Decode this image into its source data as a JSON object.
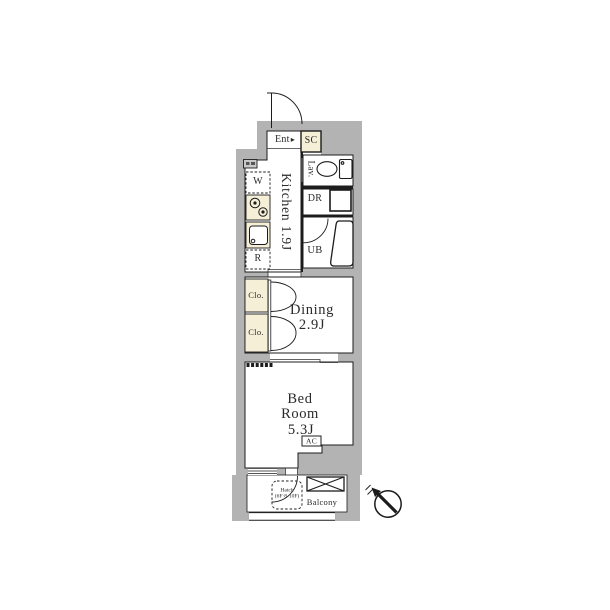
{
  "floorplan": {
    "rooms": {
      "entrance": {
        "label": "Ent"
      },
      "shoe_closet": {
        "label": "SC"
      },
      "lavatory": {
        "label": "Lav."
      },
      "dressing_room": {
        "label": "DR"
      },
      "unit_bath": {
        "label": "UB"
      },
      "kitchen": {
        "label": "Kitchen 1.9J"
      },
      "dining": {
        "label": "Dining",
        "area": "2.9J"
      },
      "bedroom": {
        "label_line1": "Bed",
        "label_line2": "Room",
        "area": "5.3J"
      },
      "balcony": {
        "label": "Balcony"
      }
    },
    "fixtures": {
      "washing_machine": {
        "label": "W"
      },
      "refrigerator": {
        "label": "R"
      },
      "closet_upper": {
        "label": "Clo."
      },
      "closet_lower": {
        "label": "Clo."
      },
      "air_conditioner": {
        "label": "AC"
      },
      "evacuation_hatch": {
        "label_line1": "Hatch",
        "label_line2": "(6F·8-10F)"
      }
    },
    "icons": {
      "entry_arrow": "▸"
    },
    "colors": {
      "wall_gray": "#b3b3b3",
      "fixture_cream": "#f5efd8",
      "line": "#1c1c1c"
    }
  }
}
